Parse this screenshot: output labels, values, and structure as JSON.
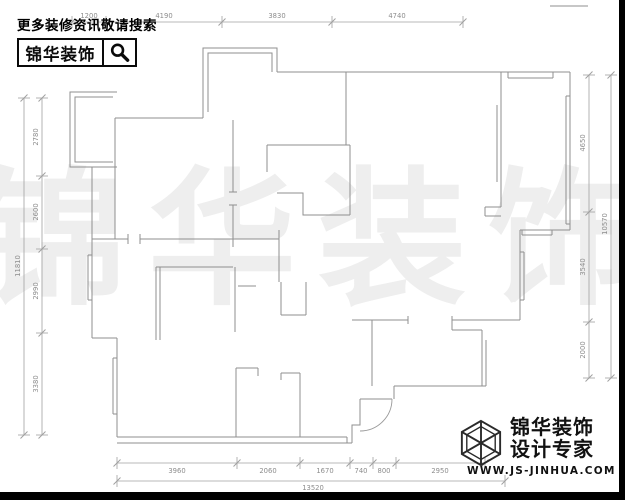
{
  "header": {
    "slogan": "更多装修资讯敬请搜索",
    "brand": "锦华装饰"
  },
  "watermark": {
    "text": "锦华装饰",
    "color": "#eeeeee"
  },
  "footer": {
    "brand_line1": "锦华装饰",
    "brand_line2": "设计专家",
    "url": "WWW.JS-JINHUA.COM"
  },
  "colors": {
    "wall": "#8f8f8f",
    "dim_line": "#a0a0a0",
    "dim_text": "#8d8d8d",
    "arc": "#9a9a9a"
  },
  "dimensions": {
    "top_segments": [
      "1200",
      "4190",
      "3830",
      "4740"
    ],
    "left_segments": [
      "2780",
      "2600",
      "2990",
      "3380"
    ],
    "left_overall": "11810",
    "right_segments": [
      "4650",
      "3540",
      "2000"
    ],
    "right_overall": "10570",
    "bottom_segments": [
      "3960",
      "2060",
      "1670",
      "740",
      "800",
      "2950"
    ],
    "bottom_overall": "13520"
  },
  "dim_rows": [
    {
      "dir": "h",
      "a": 72,
      "b": 463,
      "pos": 22,
      "ticks": [
        72,
        106,
        222,
        332,
        463
      ],
      "text_off": -4,
      "labels": [
        {
          "t": "1200",
          "p": 89
        },
        {
          "t": "4190",
          "p": 164
        },
        {
          "t": "3830",
          "p": 277
        },
        {
          "t": "4740",
          "p": 397
        }
      ]
    },
    {
      "dir": "h",
      "a": 117,
      "b": 485,
      "pos": 463,
      "ticks": [
        117,
        237,
        300,
        350,
        373,
        396,
        485
      ],
      "text_off": 10,
      "labels": [
        {
          "t": "3960",
          "p": 177
        },
        {
          "t": "2060",
          "p": 268
        },
        {
          "t": "1670",
          "p": 325
        },
        {
          "t": "740",
          "p": 361
        },
        {
          "t": "800",
          "p": 384
        },
        {
          "t": "2950",
          "p": 440
        }
      ]
    },
    {
      "dir": "h",
      "a": 117,
      "b": 505,
      "pos": 481,
      "ticks": [
        117,
        505
      ],
      "text_off": 9,
      "labels": [
        {
          "t": "13520",
          "p": 313
        }
      ]
    },
    {
      "dir": "v",
      "a": 98,
      "b": 435,
      "pos": 42,
      "ticks": [
        98,
        176,
        249,
        333,
        435
      ],
      "text_off": -4,
      "labels": [
        {
          "t": "2780",
          "p": 137
        },
        {
          "t": "2600",
          "p": 212
        },
        {
          "t": "2990",
          "p": 291
        },
        {
          "t": "3380",
          "p": 384
        }
      ]
    },
    {
      "dir": "v",
      "a": 98,
      "b": 435,
      "pos": 24,
      "ticks": [
        98,
        435
      ],
      "text_off": -4,
      "labels": [
        {
          "t": "11810",
          "p": 266
        }
      ]
    },
    {
      "dir": "v",
      "a": 75,
      "b": 378,
      "pos": 589,
      "ticks": [
        75,
        212,
        322,
        378
      ],
      "text_off": -4,
      "labels": [
        {
          "t": "4650",
          "p": 143
        },
        {
          "t": "3540",
          "p": 267
        },
        {
          "t": "2000",
          "p": 350
        }
      ]
    },
    {
      "dir": "v",
      "a": 75,
      "b": 378,
      "pos": 611,
      "ticks": [
        75,
        378
      ],
      "text_off": -4,
      "labels": [
        {
          "t": "10570",
          "p": 224
        }
      ]
    }
  ],
  "floorplan": {
    "walls": [
      "M115,118 H203",
      "M203,118 V112",
      "M203,112 V48 H277 V72",
      "M208,112 V53 H272 V72",
      "M277,72 H570",
      "M570,72 V230",
      "M508,78 H553",
      "M508,72 V78",
      "M553,72 V78",
      "M566,96 V224",
      "M566,96 H570",
      "M566,224 H570",
      "M570,230 H520",
      "M522,235 H552",
      "M522,230 V235",
      "M552,230 V235",
      "M520,230 V320",
      "M524,252 V300",
      "M520,252 H524",
      "M520,300 H524",
      "M520,320 H452",
      "M452,316 V324",
      "M408,316 V324",
      "M352,320 H408",
      "M452,320 V330",
      "M452,330 H482",
      "M482,330 V386",
      "M486,340 V386",
      "M486,386 H394",
      "M394,386 V399",
      "M372,320 V386",
      "M360,399 H392",
      "M352,443 V425 H360 V399",
      "M117,437 H347",
      "M117,443 H352",
      "M347,437 V443",
      "M117,338 V437",
      "M113,358 V414",
      "M113,358 H117",
      "M113,414 H117",
      "M92,338 H117",
      "M92,167 V338",
      "M88,255 V300",
      "M88,255 H92",
      "M88,300 H92",
      "M117,92 H70 V167 H117",
      "M113,97 H75 V162 H113",
      "M115,118 V239",
      "M92,239 H128",
      "M140,239 H279",
      "M128,234 V244",
      "M140,234 V244",
      "M233,120 V192",
      "M233,205 V247",
      "M229,192 H237",
      "M229,205 H237",
      "M279,230 V282",
      "M267,145 H350",
      "M267,145 V172",
      "M346,72 V145",
      "M350,145 V215",
      "M277,193 H303 V215 H350",
      "M281,282 V315",
      "M281,315 H306",
      "M306,282 V315",
      "M156,267 H233",
      "M156,267 V340",
      "M160,267 V340",
      "M235,267 V332",
      "M238,286 H256",
      "M236,437 V368",
      "M236,368 H258",
      "M258,368 V376",
      "M300,437 V373",
      "M300,373 H281",
      "M281,373 V380",
      "M501,72 V207",
      "M497,105 V182",
      "M501,207 H485",
      "M485,207 V216",
      "M485,216 H501",
      "M550,6 H588"
    ],
    "door_arc": "M392,399 A32,32 0 0 1 360,431"
  }
}
